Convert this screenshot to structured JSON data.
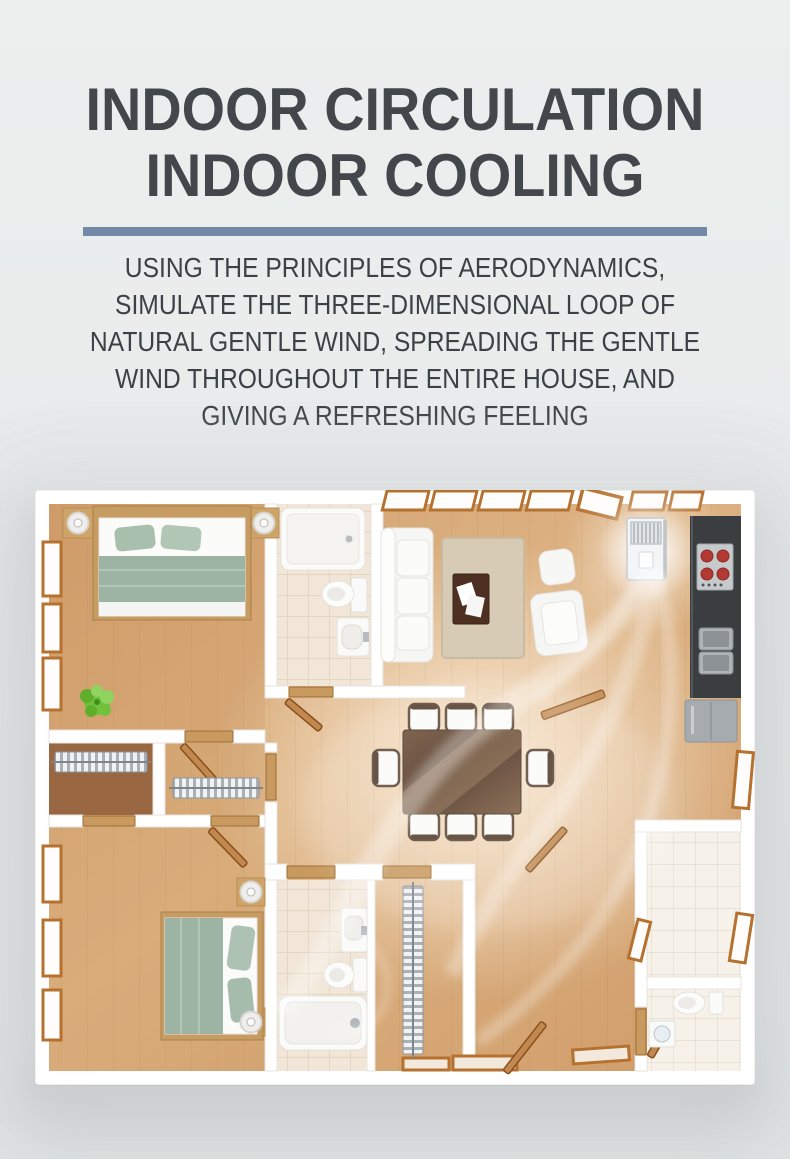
{
  "page": {
    "width": 790,
    "height": 1159,
    "background": "#e8ebeb"
  },
  "header": {
    "title_line1": "INDOOR CIRCULATION",
    "title_line2": "INDOOR COOLING",
    "title_color": "#43464a",
    "divider_color": "#7389a8"
  },
  "description": {
    "color": "#3c4146",
    "lines": [
      "USING THE PRINCIPLES OF AERODYNAMICS,",
      "SIMULATE THE THREE-DIMENSIONAL LOOP OF",
      "NATURAL GENTLE WIND, SPREADING THE GENTLE",
      "WIND THROUGHOUT THE ENTIRE HOUSE, AND",
      "GIVING A REFRESHING FEELING"
    ]
  },
  "floor_plan": {
    "caption": "Top-down 3D apartment floor plan showing gentle wind circulating from a floor-standing air conditioner through every room",
    "air_conditioner": {
      "type": "floor-standing AC unit",
      "location": "living room wall beside kitchen"
    },
    "airflow_color": "rgba(255,255,255,0.45)",
    "rooms": [
      "master bedroom",
      "en-suite bathroom",
      "living room",
      "kitchen",
      "dining area",
      "walk-in closets",
      "second bedroom",
      "second bathroom",
      "utility room",
      "guest toilet"
    ],
    "furniture": [
      "double bed",
      "nightstands with lamps",
      "potted plant",
      "shower",
      "toilet",
      "washbasin",
      "sofa",
      "rug",
      "coffee table",
      "ottoman",
      "armchair",
      "stove with four burners",
      "double sink",
      "kitchen cabinet",
      "dining table with eight chairs",
      "wardrobe rails",
      "bathtub",
      "single bed"
    ],
    "colors": {
      "floor_wood": "#d9ad7d",
      "walls": "#ffffff",
      "tile": "#f1e6d7",
      "closet_floor": "#9a6743",
      "bedding_sage": "#9fb5a6",
      "table_wood": "#5d4330",
      "kitchen_counter": "#3b3e41",
      "stove_burner_red": "#b23a33",
      "plant_green": "#72c13d",
      "door_wood": "#b5712f"
    }
  }
}
